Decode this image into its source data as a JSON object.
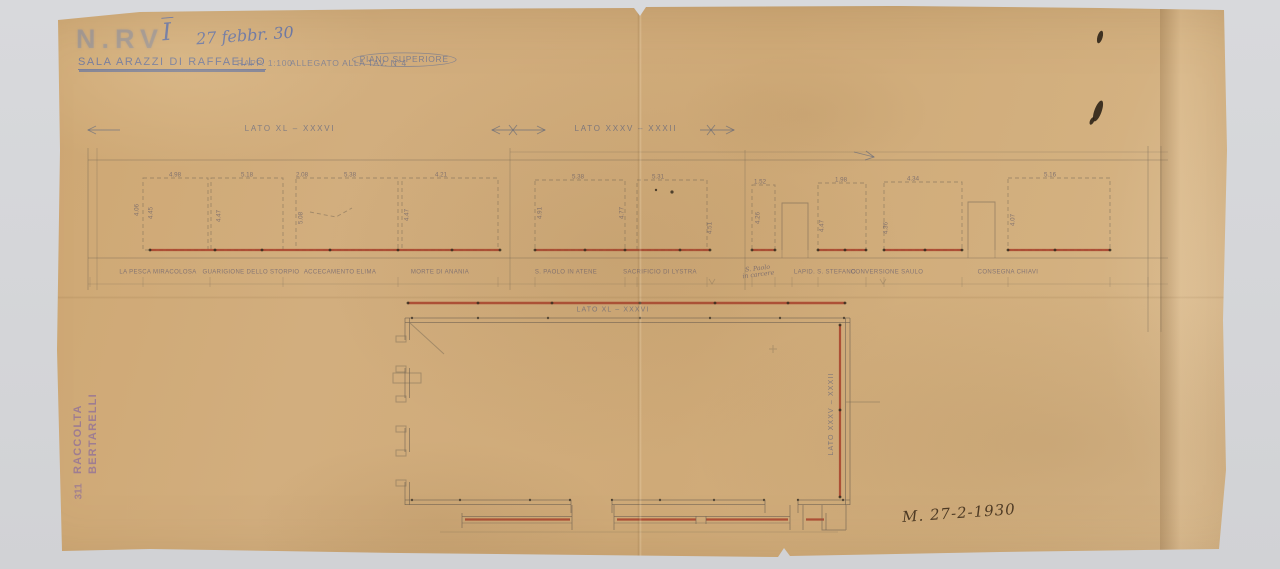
{
  "document": {
    "archive_stamp": "N.RV",
    "hand_index": "I̅",
    "hand_date": "27 febbr. 30",
    "title": "SALA ARAZZI DI RAFFAELLO",
    "scale_note": "RAPP. 1:100",
    "reference_note": "ALLEGATO ALLA TAV. N°4",
    "floor_note": "PIANO SUPERIORE",
    "signature_date": "M. 27-2-1930",
    "collection_stamp": {
      "line1": "RACCOLTA",
      "line2": "BERTARELLI",
      "number": "311"
    }
  },
  "elevations": {
    "left_section_label": "LATO XL – XXXVI",
    "right_section_label": "LATO XXXV – XXXII",
    "extra_dims": {
      "far_left": "4.06",
      "mid_step": "2.08",
      "group2_mid": "4.77"
    },
    "panels": [
      {
        "top_dim": "4.98",
        "side_dim": "4.45",
        "label": "LA PESCA MIRACOLOSA"
      },
      {
        "top_dim": "5.18",
        "side_dim": "4.47",
        "label": "GUARIGIONE DELLO STORPIO"
      },
      {
        "top_dim": "5.38",
        "side_dim": "5.08",
        "label": "ACCECAMENTO ELIMA"
      },
      {
        "top_dim": "4.21",
        "side_dim": "4.47",
        "label": "MORTE DI ANANIA"
      },
      {
        "top_dim": "5.38",
        "side_dim": "4.91",
        "label": "S. PAOLO IN ATENE"
      },
      {
        "top_dim": "5.31",
        "side_dim": "4.51",
        "label": "SACRIFICIO DI LYSTRA"
      },
      {
        "top_dim": "1.52",
        "side_dim": "4.26",
        "label": "S. Paolo",
        "label2": "in carcere"
      },
      {
        "top_dim": "1.98",
        "side_dim": "4.47",
        "label": "LAPID. S. STEFANO"
      },
      {
        "top_dim": "4.34",
        "side_dim": "4.36",
        "label": "CONVERSIONE SAULO"
      },
      {
        "top_dim": "5.16",
        "side_dim": "4.07",
        "label": "CONSEGNA CHIAVI"
      }
    ]
  },
  "plan": {
    "top_wall_label": "LATO XL – XXXVI",
    "right_wall_label": "LATO XXXV – XXXII"
  },
  "colors": {
    "paper": "#d1ad7c",
    "red_line": "#a8432c",
    "pencil": "#6f6353",
    "blue_ink": "#5a6fae",
    "stamp_violet": "#7a5fa8",
    "dark_ink": "#3a2d1d"
  }
}
